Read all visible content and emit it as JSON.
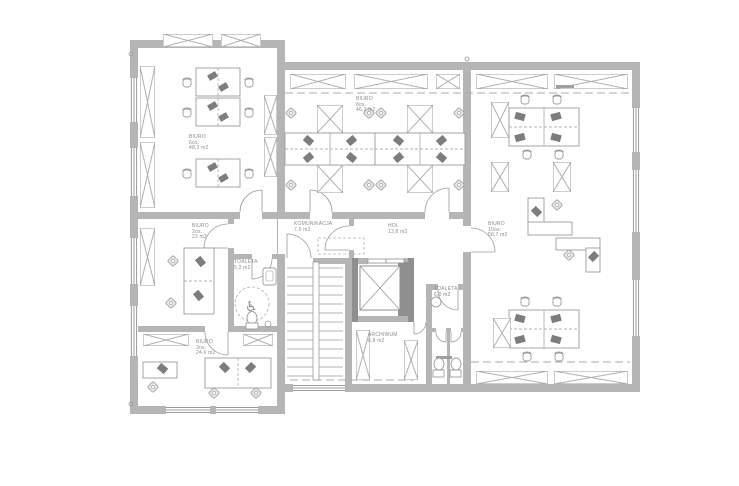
{
  "meta": {
    "drawing_type": "architectural office floor plan (CAD)",
    "background": "#ffffff"
  },
  "colors": {
    "wall": "#b5b5b5",
    "wall_dark": "#8f8f8f",
    "line": "#9b9b9b",
    "furniture_dark": "#7d7d7d",
    "label_text": "#8c8c8c"
  },
  "icons": {
    "wheelchair_icon": "♿"
  },
  "rooms": [
    {
      "id": "biuro-nw",
      "name": "BIURO",
      "capacity": "6os.",
      "area": "48,2 m2"
    },
    {
      "id": "biuro-n",
      "name": "BIURO",
      "capacity": "8os.",
      "area": "46,3 m2"
    },
    {
      "id": "biuro-e",
      "name": "BIURO",
      "capacity": "10os.",
      "area": "58,7 m2"
    },
    {
      "id": "biuro-w",
      "name": "BIURO",
      "capacity": "2os.",
      "area": "23 m2"
    },
    {
      "id": "biuro-sw",
      "name": "BIURO",
      "capacity": "3os.",
      "area": "24,6 m2"
    },
    {
      "id": "toaleta-w",
      "name": "TOALETA",
      "area": "5,2 m2"
    },
    {
      "id": "komunikacja",
      "name": "KOMUNIKACJA",
      "area": "7,5 m2"
    },
    {
      "id": "hol",
      "name": "HOL",
      "area": "13,8 m2"
    },
    {
      "id": "archiwum",
      "name": "ARCHIWUM",
      "area": "6,8 m2"
    },
    {
      "id": "toaleta-e",
      "name": "TOALETA",
      "area": "6,0 m2"
    }
  ]
}
